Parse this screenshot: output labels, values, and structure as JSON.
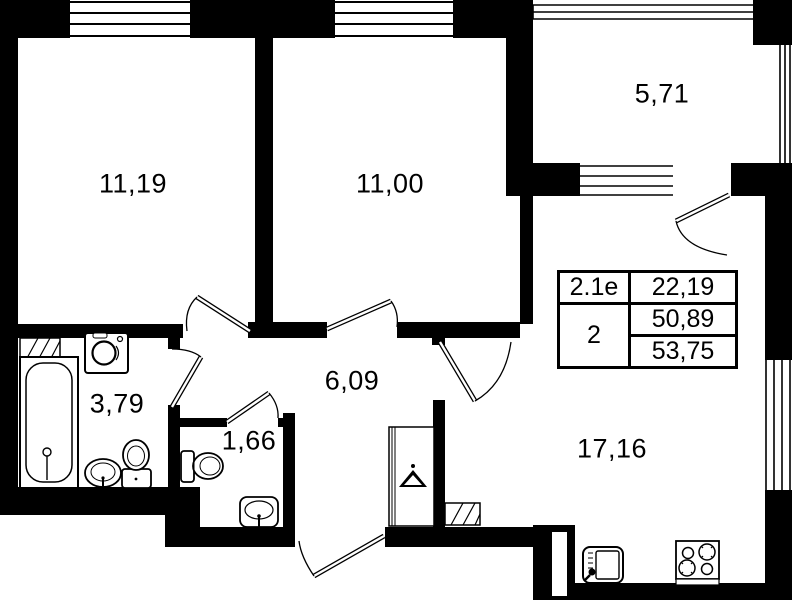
{
  "colors": {
    "wall": "#000000",
    "background": "#ffffff",
    "text": "#000000"
  },
  "rooms": {
    "bedroom1": {
      "area": "11,19"
    },
    "bedroom2": {
      "area": "11,00"
    },
    "balcony": {
      "area": "5,71"
    },
    "hallway": {
      "area": "6,09"
    },
    "bathroom": {
      "area": "3,79"
    },
    "wc": {
      "area": "1,66"
    },
    "kitchen_living": {
      "area": "17,16"
    }
  },
  "info_table": {
    "unit_type": "2.1e",
    "living_area": "22,19",
    "room_count": "2",
    "area_main": "50,89",
    "area_total": "53,75"
  },
  "icons": [
    "bathtub-icon",
    "washing-machine-icon",
    "pedestal-sink-icon",
    "toilet-icon",
    "wc-toilet-icon",
    "wc-sink-icon",
    "wardrobe-hanger-icon",
    "kitchen-sink-icon",
    "stove-icon",
    "vent-shaft-icon",
    "door-swing-icon",
    "window-icon"
  ]
}
